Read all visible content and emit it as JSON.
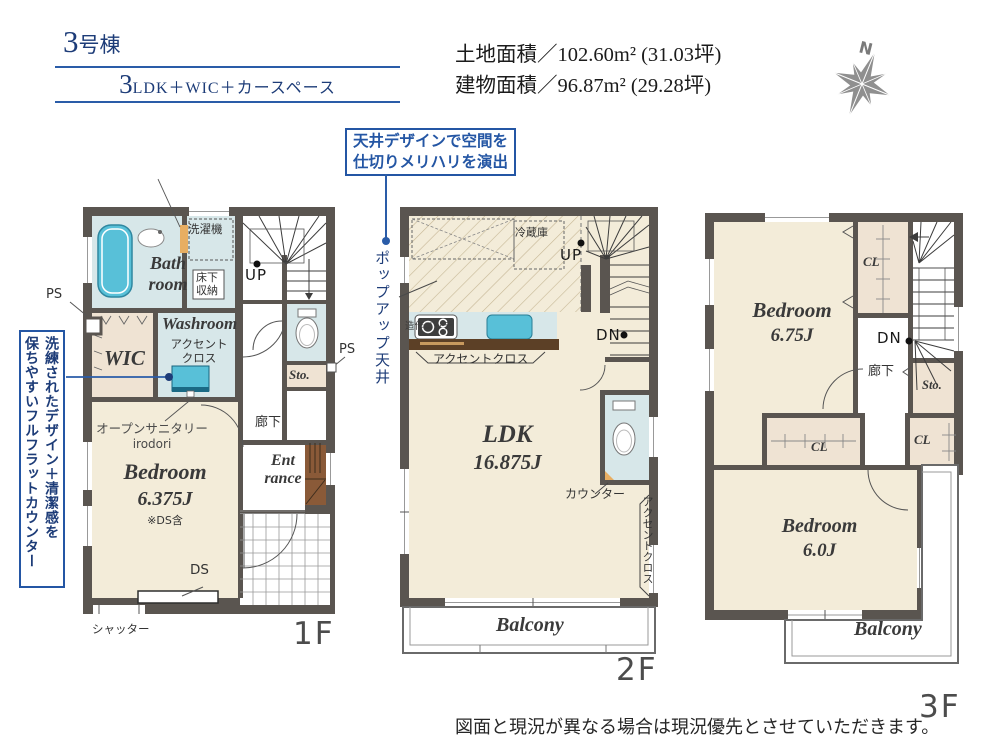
{
  "palette": {
    "accent_blue": "#2a5ca8",
    "navy_text": "#1d3c78",
    "wall_gray": "#5a5550",
    "floor_cream": "#f3ecd9",
    "wet_blue": "#d7e7e9",
    "fixture_cyan": "#58c0d8",
    "closet_beige": "#efe3d3",
    "counter_brown": "#5c4026",
    "step_brown": "#8a5a38",
    "accent_orange": "#e8ae62",
    "floor_tag_gray": "#4c4c4c"
  },
  "header": {
    "unit": "3号棟",
    "layout_num": "3",
    "layout_rest": "LDK＋WIC＋カースペース",
    "land_area": "土地面積／102.60m² (31.03坪)",
    "building_area": "建物面積／96.87m² (29.28坪)"
  },
  "compass": {
    "n": "N"
  },
  "callout": {
    "line1": "天井デザインで空間を",
    "line2": "仕切りメリハリを演出",
    "pointer": "ポップアップ天井"
  },
  "side_note": {
    "line1": "洗練されたデザイン＋清潔感を",
    "line2": "保ちやすいフルフラットカウンター"
  },
  "floor1": {
    "tag": "1F",
    "bath_l1": "Bath",
    "bath_l2": "room",
    "washer": "洗濯機",
    "underfloor_l1": "床下",
    "underfloor_l2": "収納",
    "up": "UP",
    "washroom": "Washroom",
    "accent_l1": "アクセント",
    "accent_l2": "クロス",
    "wic": "WIC",
    "ps_left": "PS",
    "ps_right": "PS",
    "storage": "Sto.",
    "hallway": "廊下",
    "open_sanitary": "オープンサニタリー",
    "open_sanitary_sub": "irodori",
    "bedroom_name": "Bedroom",
    "bedroom_size": "6.375J",
    "bedroom_note": "※DS含",
    "entrance_l1": "Ent",
    "entrance_l2": "rance",
    "ds": "DS",
    "shutter": "シャッター"
  },
  "floor2": {
    "tag": "2F",
    "fridge": "冷蔵庫",
    "up": "UP",
    "dn": "DN",
    "niche": "造作ニッチ",
    "accent_bottom": "アクセントクロス",
    "ldk_name": "LDK",
    "ldk_size": "16.875J",
    "counter": "カウンター",
    "accent_right": "アクセントクロス",
    "balcony": "Balcony"
  },
  "floor3": {
    "tag": "3F",
    "bedroom1_name": "Bedroom",
    "bedroom1_size": "6.75J",
    "cl_top": "CL",
    "dn": "DN",
    "hallway": "廊下",
    "storage": "Sto.",
    "cl_mid": "CL",
    "cl_right": "CL",
    "bedroom2_name": "Bedroom",
    "bedroom2_size": "6.0J",
    "balcony": "Balcony"
  },
  "footer": {
    "disclaimer": "図面と現況が異なる場合は現況優先とさせていただきます。"
  }
}
